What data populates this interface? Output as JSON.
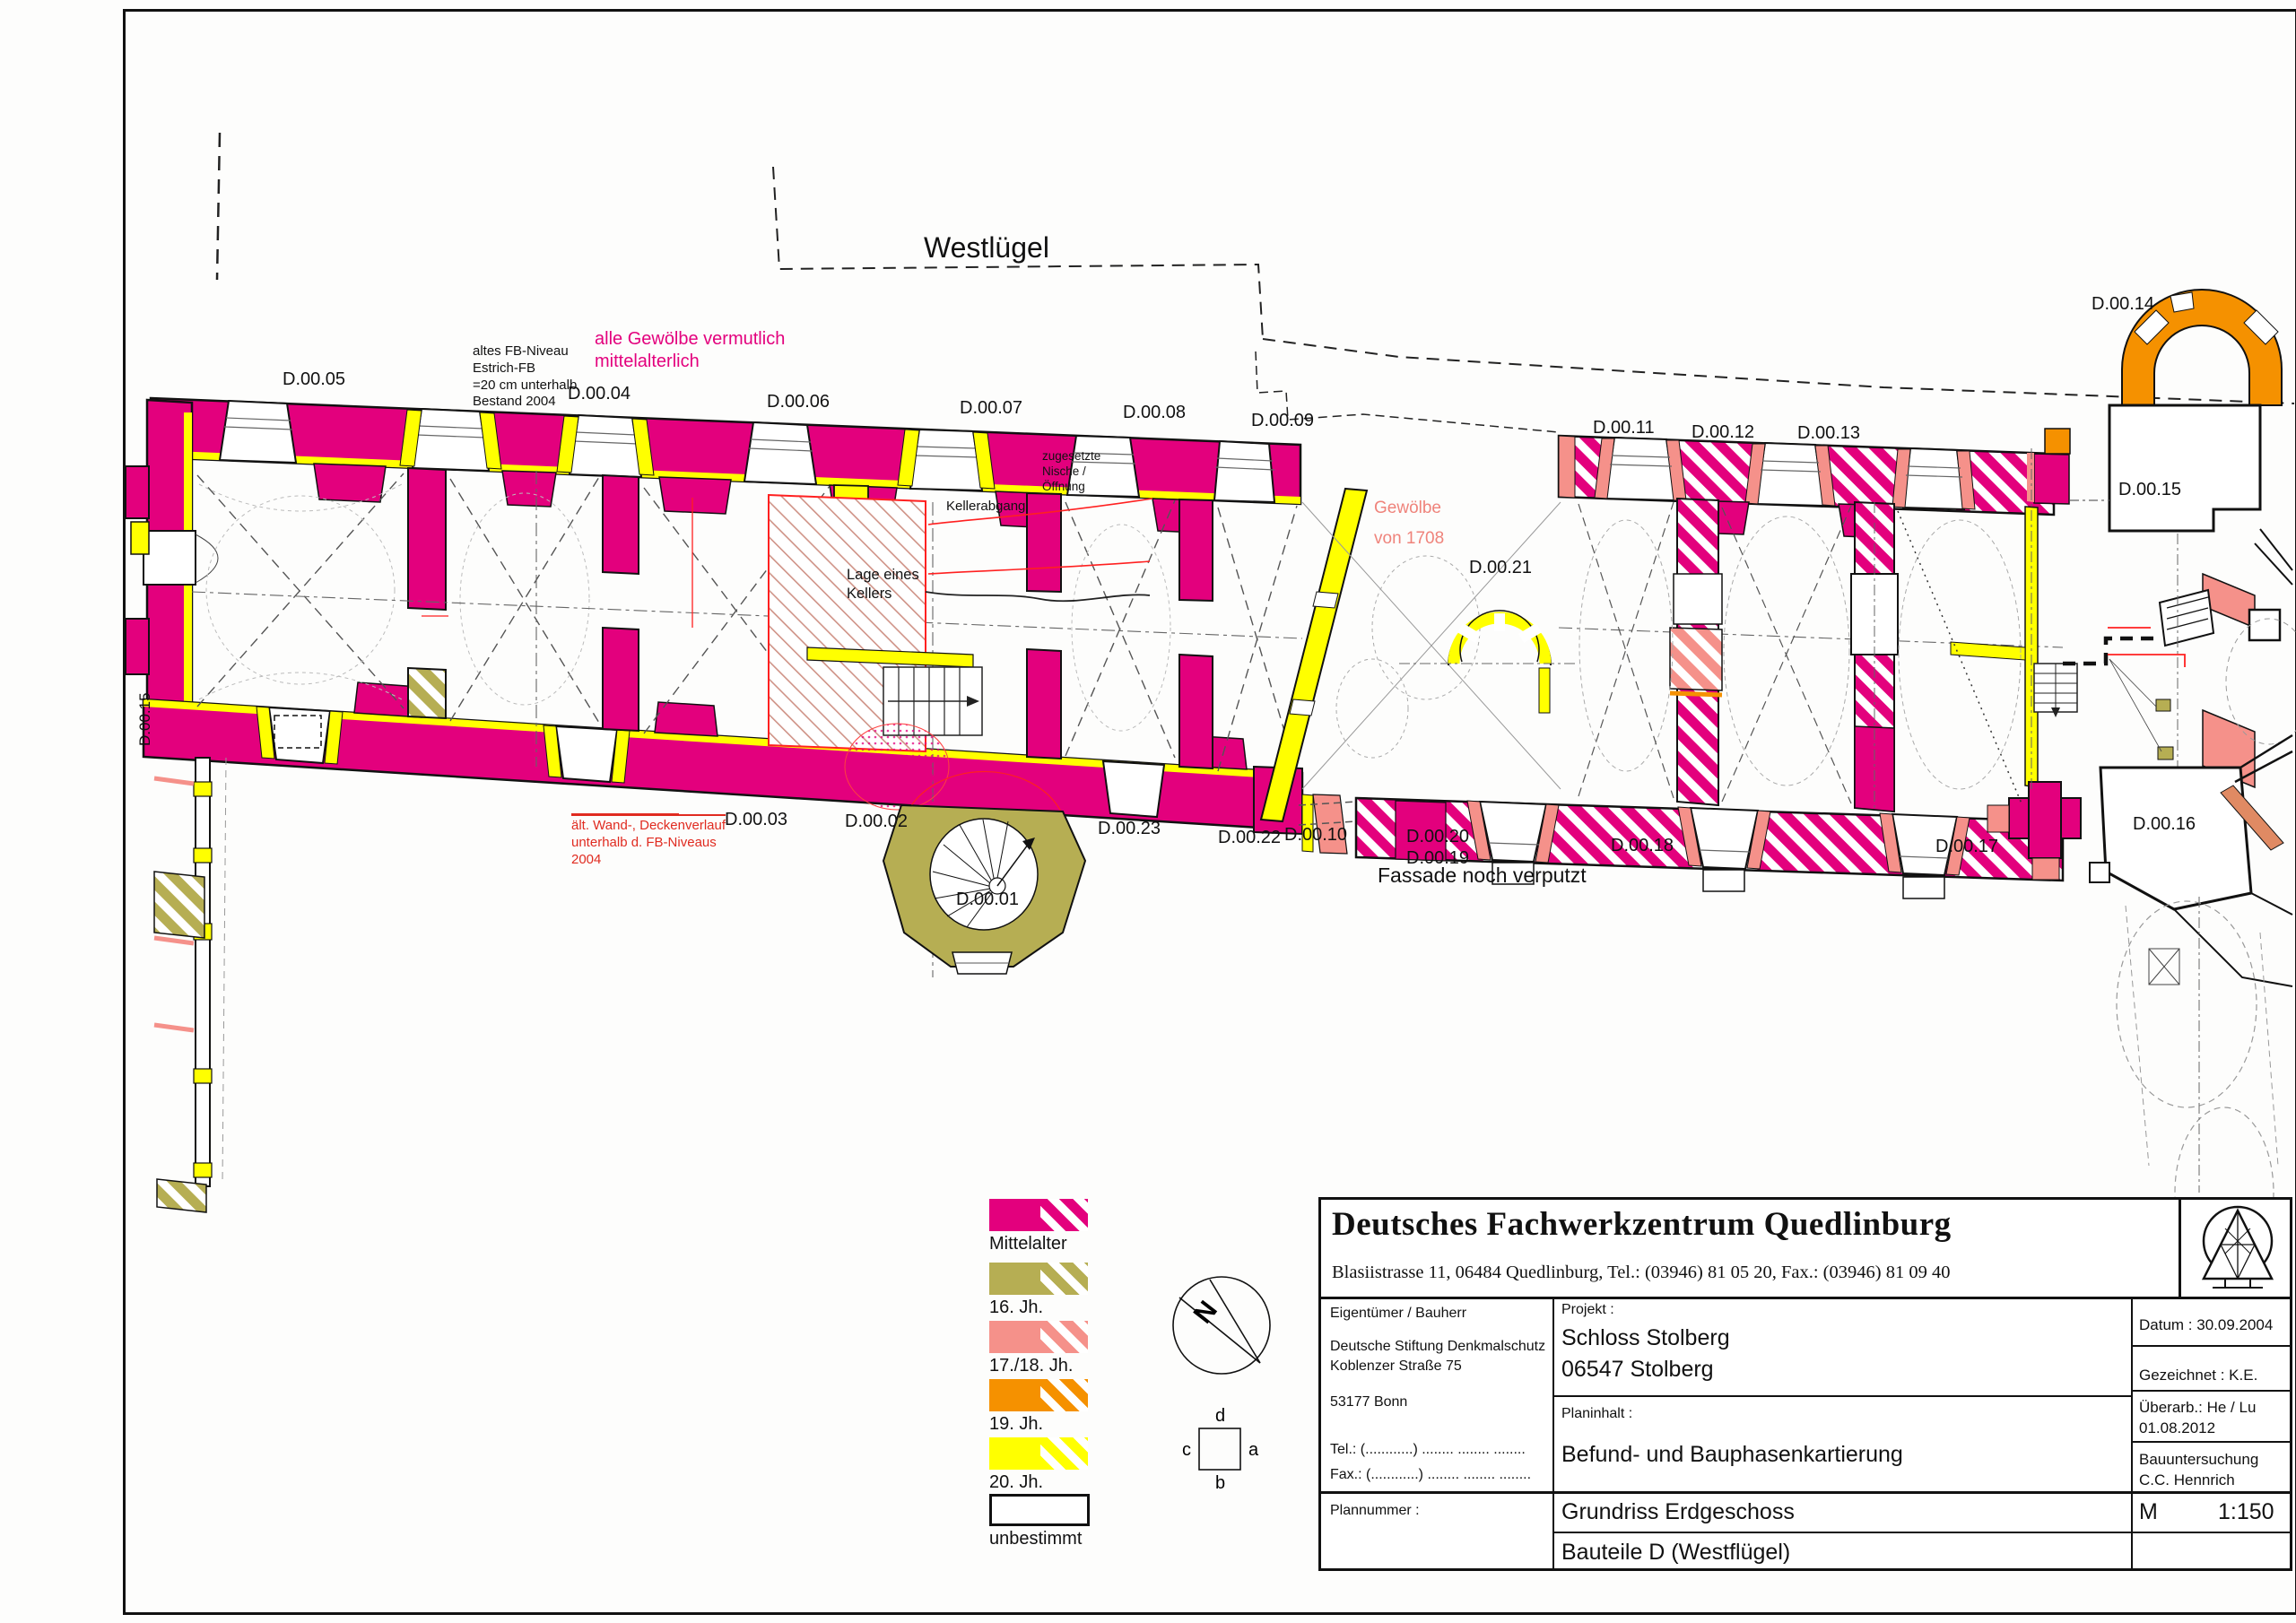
{
  "colors": {
    "mittelalter": "#e3007d",
    "jh16": "#b6ae53",
    "jh17_18": "#f5918a",
    "jh19": "#f59100",
    "jh20": "#ffff00",
    "unbestimmt": "#ffffff",
    "annotation_red": "#e02b20",
    "annotation_salmon": "#ef837b"
  },
  "plan": {
    "heading": "Westlügel",
    "rooms": [
      "D.00.05",
      "D.00.04",
      "D.00.06",
      "D.00.07",
      "D.00.08",
      "D.00.09",
      "D.00.11",
      "D.00.12",
      "D.00.13",
      "D.00.14",
      "D.00.15",
      "D.00.21",
      "D.00.03",
      "D.00.02",
      "D.00.23",
      "D.00.22",
      "D.00.10",
      "D.00.20",
      "D.00.19",
      "D.00.18",
      "D.00.17",
      "D.00.16",
      "D.00.01",
      "D.00.15"
    ],
    "annotations": {
      "fb_niveau": "altes FB-Niveau\nEstrich-FB\n=20 cm unterhalb\nBestand 2004",
      "gewoelbe_ma": "alle Gewölbe vermutlich\nmittelalterlich",
      "nische": "zugesetzte\nNische /\nÖffnung",
      "kellerabgang": "Kellerabgang",
      "keller": "Lage eines\nKellers",
      "gewoelbe_1708": "Gewölbe\nvon 1708",
      "alt_wand": "ält. Wand-, Deckenverlauf\nunterhalb d. FB-Niveaus\n2004",
      "fassade": "Fassade noch verputzt"
    }
  },
  "legend": {
    "items": [
      {
        "label": "Mittelalter",
        "color": "#e3007d"
      },
      {
        "label": "16. Jh.",
        "color": "#b6ae53"
      },
      {
        "label": "17./18. Jh.",
        "color": "#f5918a"
      },
      {
        "label": "19. Jh.",
        "color": "#f59100"
      },
      {
        "label": "20. Jh.",
        "color": "#ffff00"
      },
      {
        "label": "unbestimmt",
        "color": "#ffffff"
      }
    ]
  },
  "compass": {
    "north": "N"
  },
  "orientation": {
    "a": "a",
    "b": "b",
    "c": "c",
    "d": "d"
  },
  "titleblock": {
    "company": "Deutsches Fachwerkzentrum Quedlinburg",
    "address": "Blasiistrasse 11, 06484 Quedlinburg, Tel.: (03946) 81 05 20, Fax.: (03946) 81 09 40",
    "owner_label": "Eigentümer / Bauherr",
    "owner_1": "Deutsche Stiftung Denkmalschutz",
    "owner_2": "Koblenzer Straße 75",
    "owner_3": "53177 Bonn",
    "owner_tel": "Tel.:  (............) ........  ........  ........",
    "owner_fax": "Fax.: (............) ........  ........  ........",
    "plannumber_label": "Plannummer :",
    "project_label": "Projekt  :",
    "project_1": "Schloss Stolberg",
    "project_2": "06547 Stolberg",
    "content_label": "Planinhalt  :",
    "content_value": "Befund- und Bauphasenkartierung",
    "sheet_1": "Grundriss Erdgeschoss",
    "sheet_2": "Bauteile D (Westflügel)",
    "date": "Datum :  30.09.2004",
    "drawn": "Gezeichnet : K.E.",
    "revised_1": "Überarb.: He / Lu",
    "revised_2": "01.08.2012",
    "survey_1": "Bauuntersuchung",
    "survey_2": "C.C. Hennrich",
    "scale_m": "M",
    "scale_value": "1:150"
  }
}
